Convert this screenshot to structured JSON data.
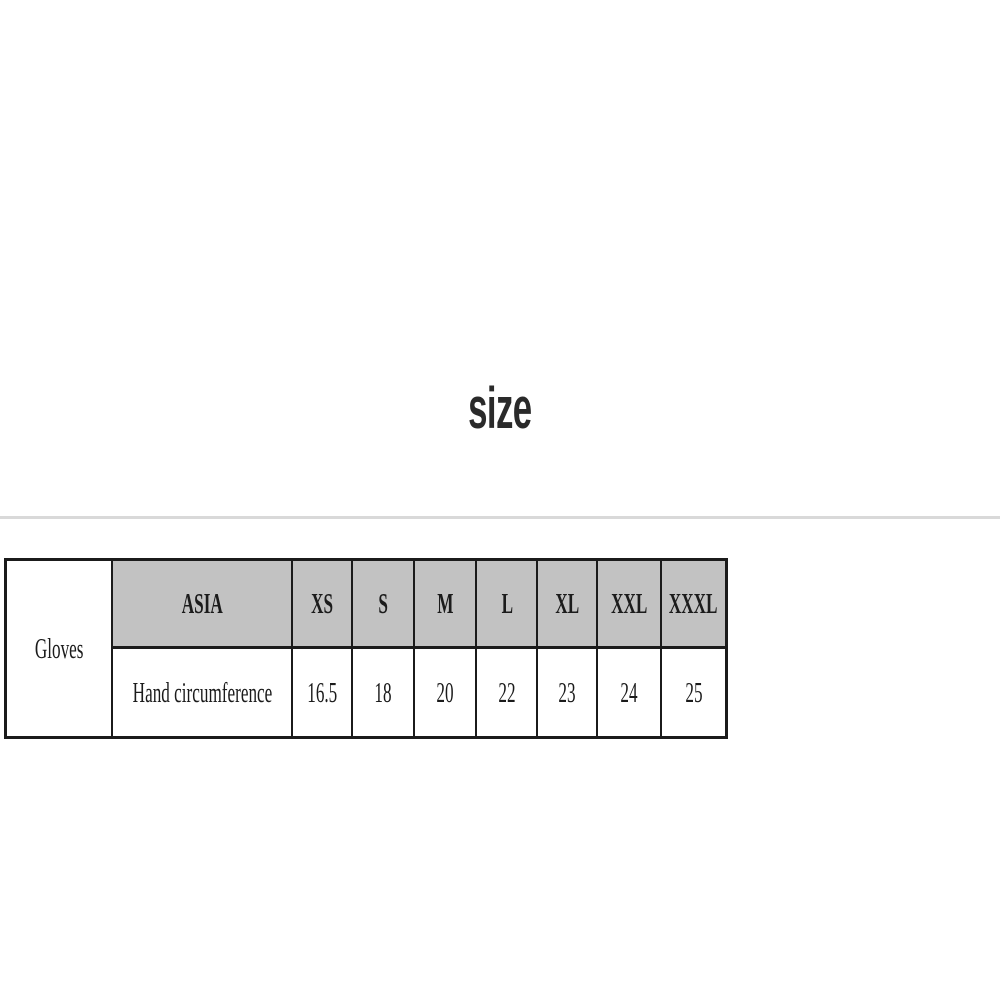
{
  "page": {
    "title": "size"
  },
  "size_chart": {
    "category_label": "Gloves",
    "region_header": "ASIA",
    "size_headers": [
      "XS",
      "S",
      "M",
      "L",
      "XL",
      "XXL",
      "XXXL"
    ],
    "measurement_label": "Hand circumference",
    "measurements": [
      "16.5",
      "18",
      "20",
      "22",
      "23",
      "24",
      "25"
    ],
    "colors": {
      "header_bg": "#c2c2c2",
      "border": "#1b1b1b",
      "divider": "#d9d9d9",
      "title_text": "#2a2a2a"
    }
  }
}
